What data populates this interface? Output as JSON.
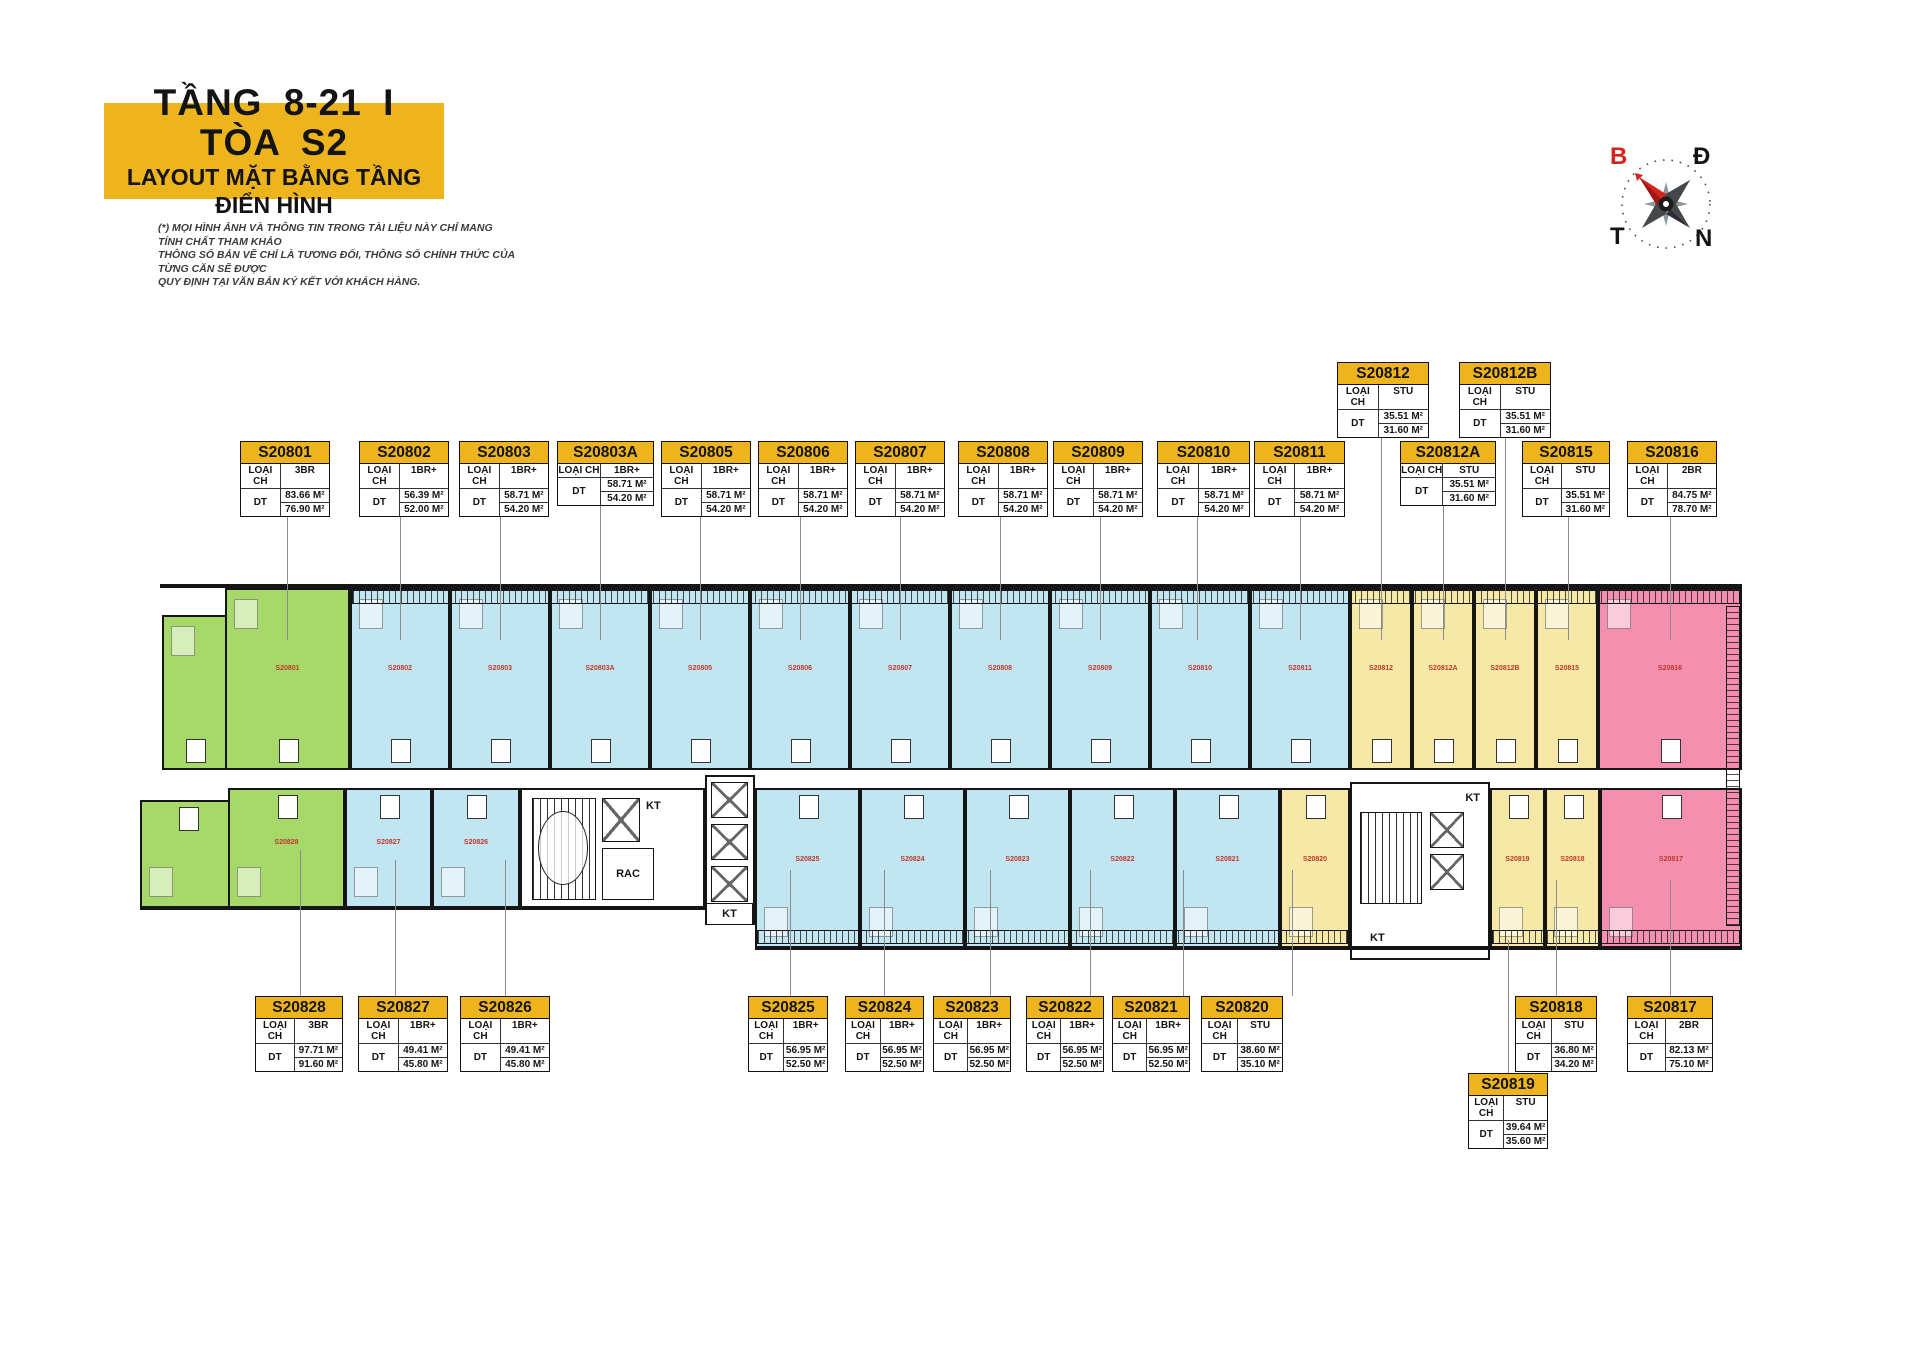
{
  "title": {
    "line1": "TẦNG 8-21 I TÒA S2",
    "line2": "LAYOUT MẶT BẰNG TẦNG ĐIỂN HÌNH"
  },
  "disclaimer": {
    "line1": "(*) MỌI HÌNH ẢNH VÀ THÔNG TIN TRONG TÀI LIỆU NÀY CHỈ MANG TÍNH CHẤT THAM KHẢO",
    "line2": "THÔNG SỐ BẢN VẼ CHỈ LÀ TƯƠNG ĐỐI, THÔNG SỐ CHÍNH THỨC CỦA TỪNG CĂN SẼ ĐƯỢC",
    "line3": "QUY ĐỊNH TẠI VĂN BẢN KÝ KẾT VỚI KHÁCH HÀNG."
  },
  "compass": {
    "north_label": "B",
    "east_label": "Đ",
    "west_label": "T",
    "south_label": "N"
  },
  "field_labels": {
    "unit_type": "LOẠI CH",
    "area": "DT"
  },
  "plan_labels": {
    "kt_core_left": "KT",
    "kt_lift_mid": "KT",
    "kt_core_right_top": "KT",
    "kt_core_right_bottom": "KT",
    "trash_room": "RAC"
  },
  "colors": {
    "accent_yellow": "#EDB41E",
    "unit_green": "#A6D96A",
    "unit_blue": "#C2E5F2",
    "unit_yellow": "#F6E8A6",
    "unit_pink": "#F48FB0",
    "north_red": "#D42420",
    "wall_black": "#151515"
  },
  "units": [
    {
      "code": "S20801",
      "type": "3BR",
      "area1": "83.66 M²",
      "area2": "76.90 M²",
      "color": "unit_green"
    },
    {
      "code": "S20802",
      "type": "1BR+",
      "area1": "56.39 M²",
      "area2": "52.00 M²",
      "color": "unit_blue"
    },
    {
      "code": "S20803",
      "type": "1BR+",
      "area1": "58.71 M²",
      "area2": "54.20 M²",
      "color": "unit_blue"
    },
    {
      "code": "S20803A",
      "type": "1BR+",
      "area1": "58.71 M²",
      "area2": "54.20 M²",
      "color": "unit_blue"
    },
    {
      "code": "S20805",
      "type": "1BR+",
      "area1": "58.71 M²",
      "area2": "54.20 M²",
      "color": "unit_blue"
    },
    {
      "code": "S20806",
      "type": "1BR+",
      "area1": "58.71 M²",
      "area2": "54.20 M²",
      "color": "unit_blue"
    },
    {
      "code": "S20807",
      "type": "1BR+",
      "area1": "58.71 M²",
      "area2": "54.20 M²",
      "color": "unit_blue"
    },
    {
      "code": "S20808",
      "type": "1BR+",
      "area1": "58.71 M²",
      "area2": "54.20 M²",
      "color": "unit_blue"
    },
    {
      "code": "S20809",
      "type": "1BR+",
      "area1": "58.71 M²",
      "area2": "54.20 M²",
      "color": "unit_blue"
    },
    {
      "code": "S20810",
      "type": "1BR+",
      "area1": "58.71 M²",
      "area2": "54.20 M²",
      "color": "unit_blue"
    },
    {
      "code": "S20811",
      "type": "1BR+",
      "area1": "58.71 M²",
      "area2": "54.20 M²",
      "color": "unit_blue"
    },
    {
      "code": "S20812",
      "type": "STU",
      "area1": "35.51 M²",
      "area2": "31.60 M²",
      "color": "unit_yellow"
    },
    {
      "code": "S20812A",
      "type": "STU",
      "area1": "35.51 M²",
      "area2": "31.60 M²",
      "color": "unit_yellow"
    },
    {
      "code": "S20812B",
      "type": "STU",
      "area1": "35.51 M²",
      "area2": "31.60 M²",
      "color": "unit_yellow"
    },
    {
      "code": "S20815",
      "type": "STU",
      "area1": "35.51 M²",
      "area2": "31.60 M²",
      "color": "unit_yellow"
    },
    {
      "code": "S20816",
      "type": "2BR",
      "area1": "84.75 M²",
      "area2": "78.70 M²",
      "color": "unit_pink"
    },
    {
      "code": "S20817",
      "type": "2BR",
      "area1": "82.13 M²",
      "area2": "75.10 M²",
      "color": "unit_pink"
    },
    {
      "code": "S20818",
      "type": "STU",
      "area1": "36.80 M²",
      "area2": "34.20 M²",
      "color": "unit_yellow"
    },
    {
      "code": "S20819",
      "type": "STU",
      "area1": "39.64 M²",
      "area2": "35.60 M²",
      "color": "unit_yellow"
    },
    {
      "code": "S20820",
      "type": "STU",
      "area1": "38.60 M²",
      "area2": "35.10 M²",
      "color": "unit_yellow"
    },
    {
      "code": "S20821",
      "type": "1BR+",
      "area1": "56.95 M²",
      "area2": "52.50 M²",
      "color": "unit_blue"
    },
    {
      "code": "S20822",
      "type": "1BR+",
      "area1": "56.95 M²",
      "area2": "52.50 M²",
      "color": "unit_blue"
    },
    {
      "code": "S20823",
      "type": "1BR+",
      "area1": "56.95 M²",
      "area2": "52.50 M²",
      "color": "unit_blue"
    },
    {
      "code": "S20824",
      "type": "1BR+",
      "area1": "56.95 M²",
      "area2": "52.50 M²",
      "color": "unit_blue"
    },
    {
      "code": "S20825",
      "type": "1BR+",
      "area1": "56.95 M²",
      "area2": "52.50 M²",
      "color": "unit_blue"
    },
    {
      "code": "S20826",
      "type": "1BR+",
      "area1": "49.41 M²",
      "area2": "45.80 M²",
      "color": "unit_blue"
    },
    {
      "code": "S20827",
      "type": "1BR+",
      "area1": "49.41 M²",
      "area2": "45.80 M²",
      "color": "unit_blue"
    },
    {
      "code": "S20828",
      "type": "3BR",
      "area1": "97.71 M²",
      "area2": "91.60 M²",
      "color": "unit_green"
    }
  ]
}
